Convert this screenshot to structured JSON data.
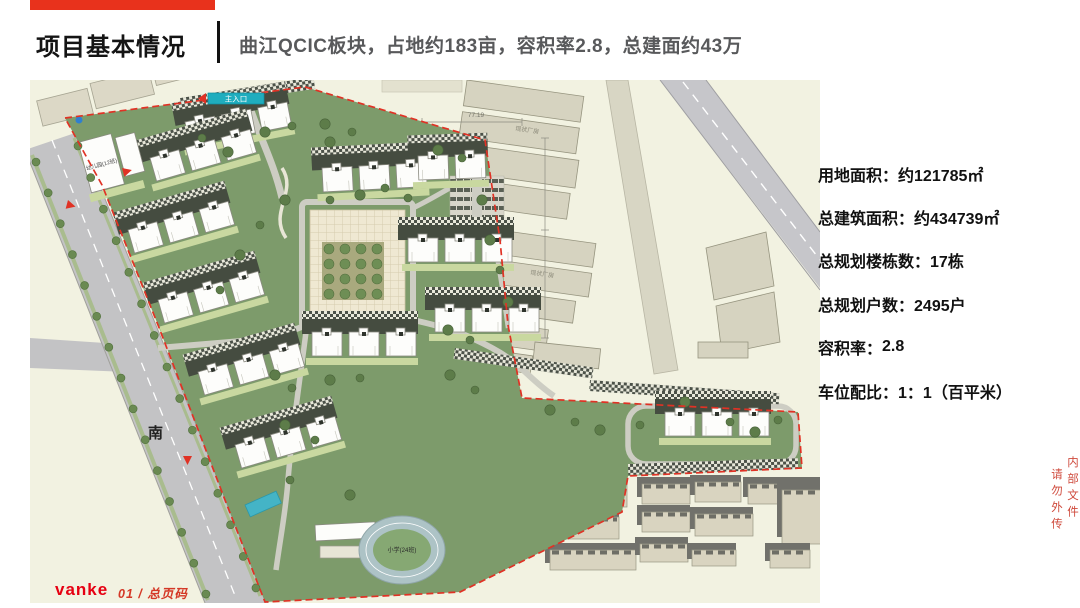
{
  "slide": {
    "accent_bar_color": "#e8321c",
    "title": "项目基本情况",
    "subtitle": "曲江QCIC板块，占地约183亩，容积率2.8，总建面约43万"
  },
  "stats": {
    "separator": "：",
    "items": [
      {
        "label": "用地面积",
        "value": "约121785㎡"
      },
      {
        "label": "总建筑面积",
        "value": "约434739㎡"
      },
      {
        "label": "总规划楼栋数",
        "value": "17栋"
      },
      {
        "label": "总规划户数",
        "value": "2495户"
      },
      {
        "label": "容积率",
        "value": "2.8"
      },
      {
        "label": "车位配比",
        "value": "1：1（百平米）"
      }
    ]
  },
  "map": {
    "labels": {
      "south_road": "南",
      "entrance": "主入口",
      "kindergarten": "幼儿园(12班)",
      "school": "小学(24班)",
      "factory_upper": "现状厂房",
      "factory_lower": "现状厂房",
      "dim_left": "65.58",
      "dim_right": "77.19"
    },
    "colors": {
      "site_green": "#7d9b6b",
      "boundary_red": "#e03225",
      "road_gray": "#c3c3c5",
      "outside_beige": "#f2f2e1",
      "existing_building": "#d9d4c0",
      "pool_teal": "#44b4c6",
      "entrance_tag_teal": "#1fadbe"
    }
  },
  "footer": {
    "logo_text": "vanke",
    "page_text": "01 / 总页码"
  },
  "watermark": {
    "line1": "内部文件",
    "line2": "请勿外传"
  }
}
